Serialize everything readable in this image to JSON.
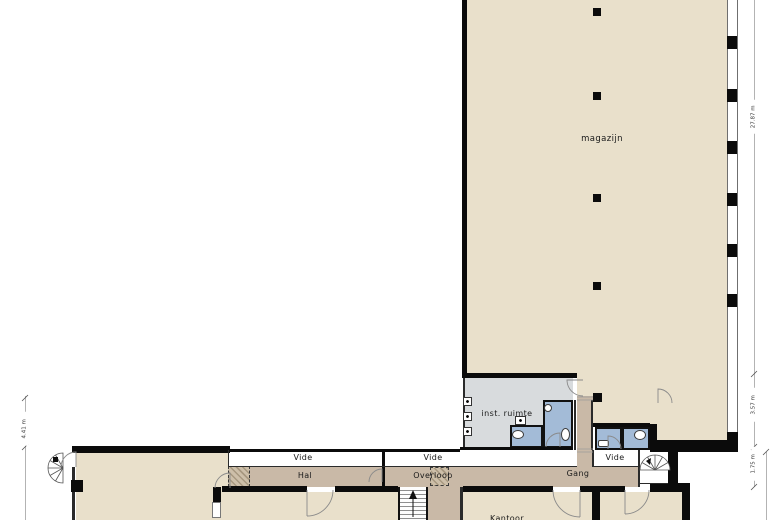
{
  "plan": {
    "title": "floor-plan",
    "colors": {
      "room_fill": "#e9e0cb",
      "service_room_fill": "#d8dbdd",
      "sanitary_fill": "#a3bbd7",
      "corridor_fill": "#c9b9a7",
      "wall": "#0b0b0b",
      "background": "#ffffff"
    },
    "rooms": {
      "magazijn": "magazijn",
      "inst_ruimte": "inst. ruimte",
      "vide_1": "Vide",
      "vide_2": "Vide",
      "vide_3": "Vide",
      "hal": "Hal",
      "overloop": "Overloop",
      "gang": "Gang",
      "kantoor": "Kantoor"
    },
    "dimensions": {
      "right_top": "27.87 m",
      "right_middle": "3.57 m",
      "right_bottom": "1.75 m",
      "left": "4.41 m"
    },
    "icons": {
      "spiral_stair": "fan shape with radial treads",
      "straight_stair": "parallel treads with up arrow",
      "door_swing": "quarter-circle arc",
      "toilet": "white oval",
      "sink": "small white box",
      "meter_panel": "small square with dot",
      "elevator": "hatched square",
      "column": "black square"
    }
  }
}
